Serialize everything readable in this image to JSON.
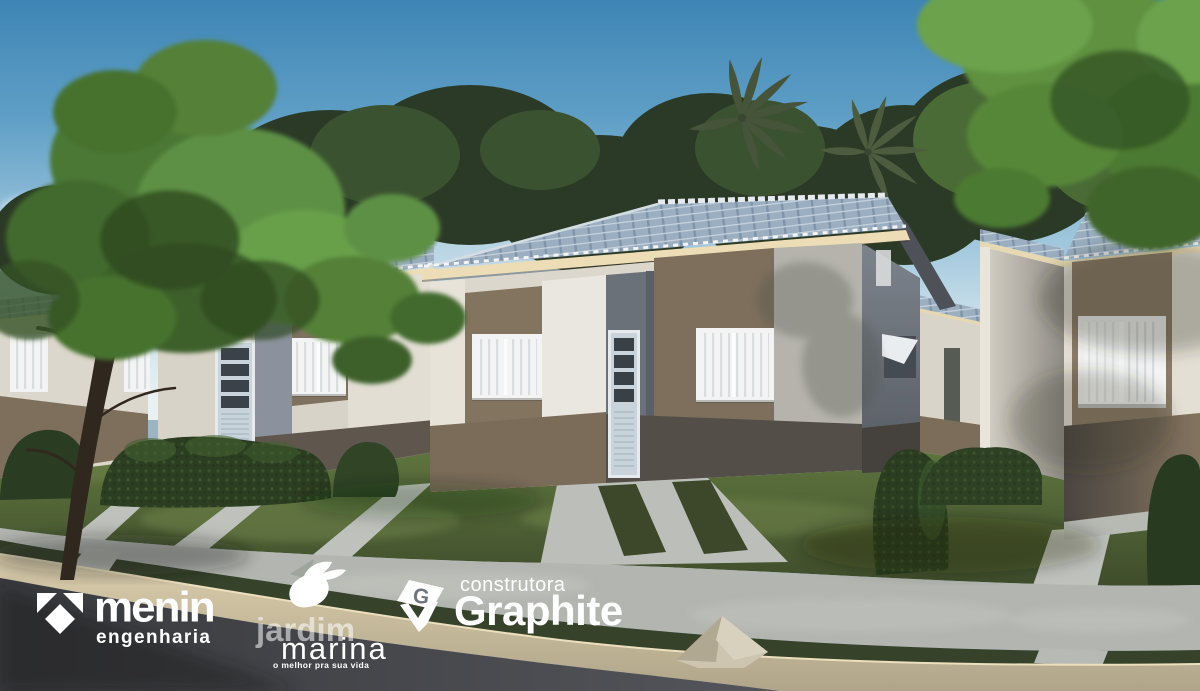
{
  "branding": {
    "menin": {
      "icon": "menin-triangles-icon",
      "wordmark": "menin",
      "subtitle": "engenharia"
    },
    "jardim_marina": {
      "icon": "dove-icon",
      "line1": "jardim",
      "line2": "marina",
      "tagline": "o melhor pra sua vida"
    },
    "graphite": {
      "icon": "gem-icon",
      "kicker": "construtora",
      "wordmark": "Graphite"
    }
  },
  "palette": {
    "sky_top": "#3e85b5",
    "sky_horizon": "#e9f1f3",
    "roof_tile": "#9bafc1",
    "fascia_cream": "#ecddb6",
    "wall_white": "#e6e2d8",
    "wall_taupe": "#80725e",
    "wall_recess_gray": "#6b7179",
    "wainscot_dark": "#57514b",
    "lawn_green": "#5c7040",
    "hedge_green": "#2c3e22",
    "sidewalk_gray": "#b3b6b1",
    "curb_tan": "#d6c6a2",
    "road_gray": "#45464a",
    "logo_white": "#ffffff"
  }
}
